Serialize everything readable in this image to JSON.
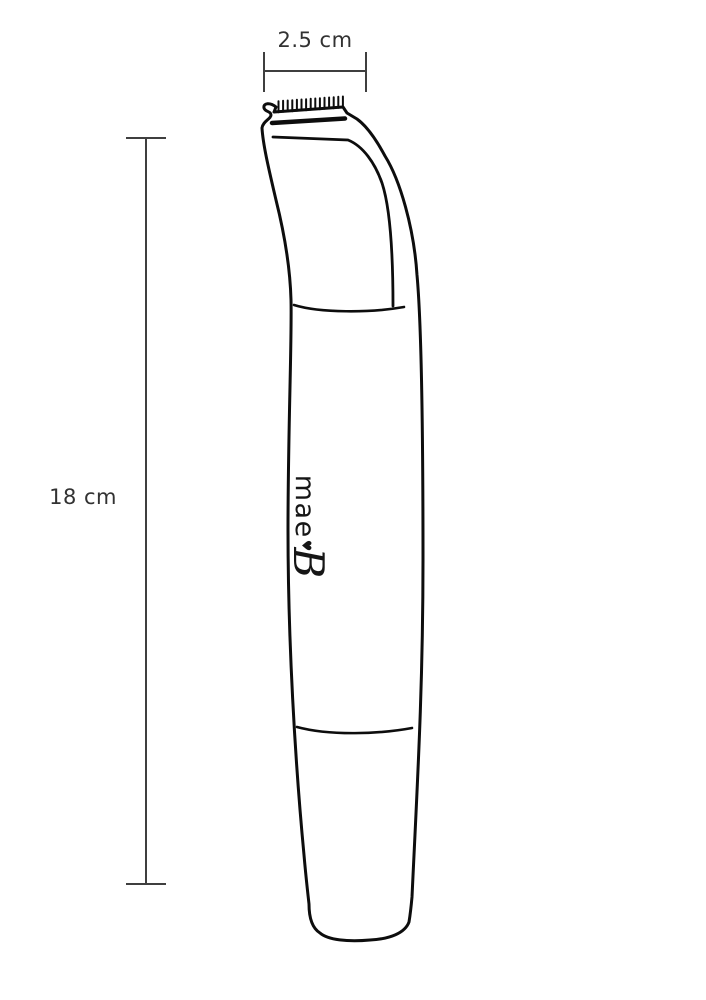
{
  "diagram": {
    "type": "product dimension drawing",
    "subject": "personal hair trimmer outline, side profile with comb teeth",
    "width_dimension": {
      "label": "2.5 cm"
    },
    "height_dimension": {
      "label": "18 cm"
    },
    "brand": {
      "prefix": "mae",
      "heart": "♥",
      "suffix": "B"
    }
  },
  "colors": {
    "background": "#ffffff",
    "device_line": "#0d0d0d",
    "dimension_line": "#3f3f3f",
    "label_text": "#323232"
  }
}
